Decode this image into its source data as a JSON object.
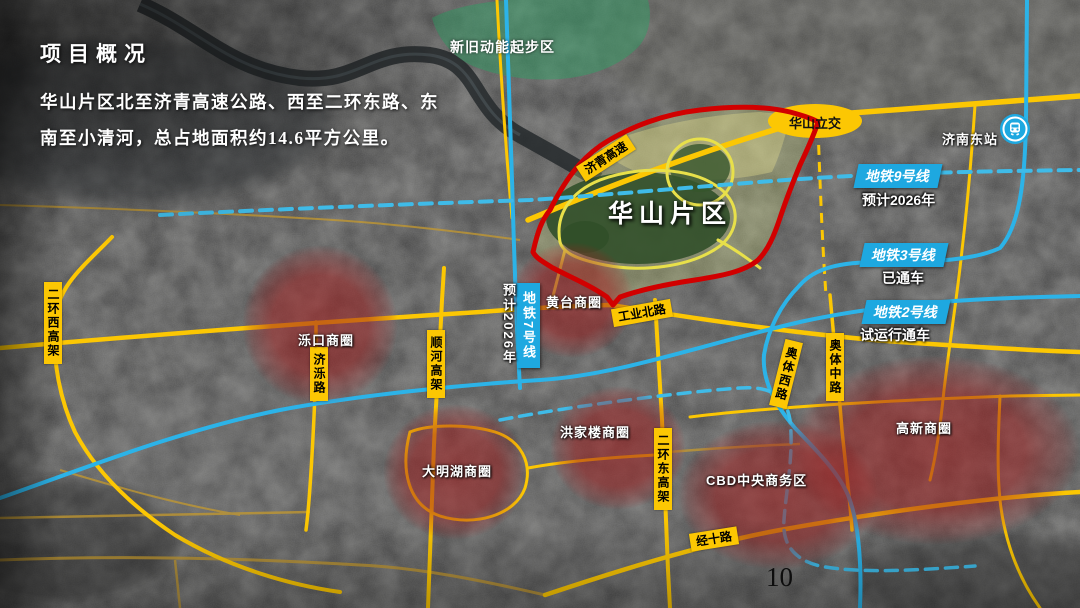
{
  "slide": {
    "title": "项目概况",
    "desc_line1": "华山片区北至济青高速公路、西至二环东路、东",
    "desc_line2": "南至小清河，总占地面积约14.6平方公里。",
    "page_number": "10"
  },
  "map": {
    "zones": {
      "qibu": "新旧动能起步区",
      "huashan": "华山片区"
    },
    "interchange": "华山立交",
    "station": "济南东站",
    "metro": {
      "m9": {
        "name": "地铁9号线",
        "status": "预计2026年"
      },
      "m3": {
        "name": "地铁3号线",
        "status": "已通车"
      },
      "m2": {
        "name": "地铁2号线",
        "status": "试运行通车"
      },
      "m7": {
        "name": "地铁7号线",
        "status": "预计2026年"
      }
    },
    "roads": {
      "jiqing": "济青高速",
      "gongye": "工业北路",
      "erhuanxi": "二环西高架",
      "jiluo": "济泺路",
      "shunhe": "顺河高架",
      "erhuandong": "二环东高架",
      "aotixi": "奥体西路",
      "aotizhong": "奥体中路",
      "jingshi": "经十路"
    },
    "circles": {
      "luokou": "泺口商圈",
      "huangtai": "黄台商圈",
      "hongjialou": "洪家楼商圈",
      "daminghu": "大明湖商圈",
      "gaoxin": "高新商圈",
      "cbd": "CBD中央商务区"
    },
    "colors": {
      "road_yellow": "#fcc703",
      "metro_blue": "#1ea8e0",
      "boundary_red": "#d10000",
      "circle_red": "#a01e1e",
      "zone_green": "#2f9e63"
    }
  }
}
